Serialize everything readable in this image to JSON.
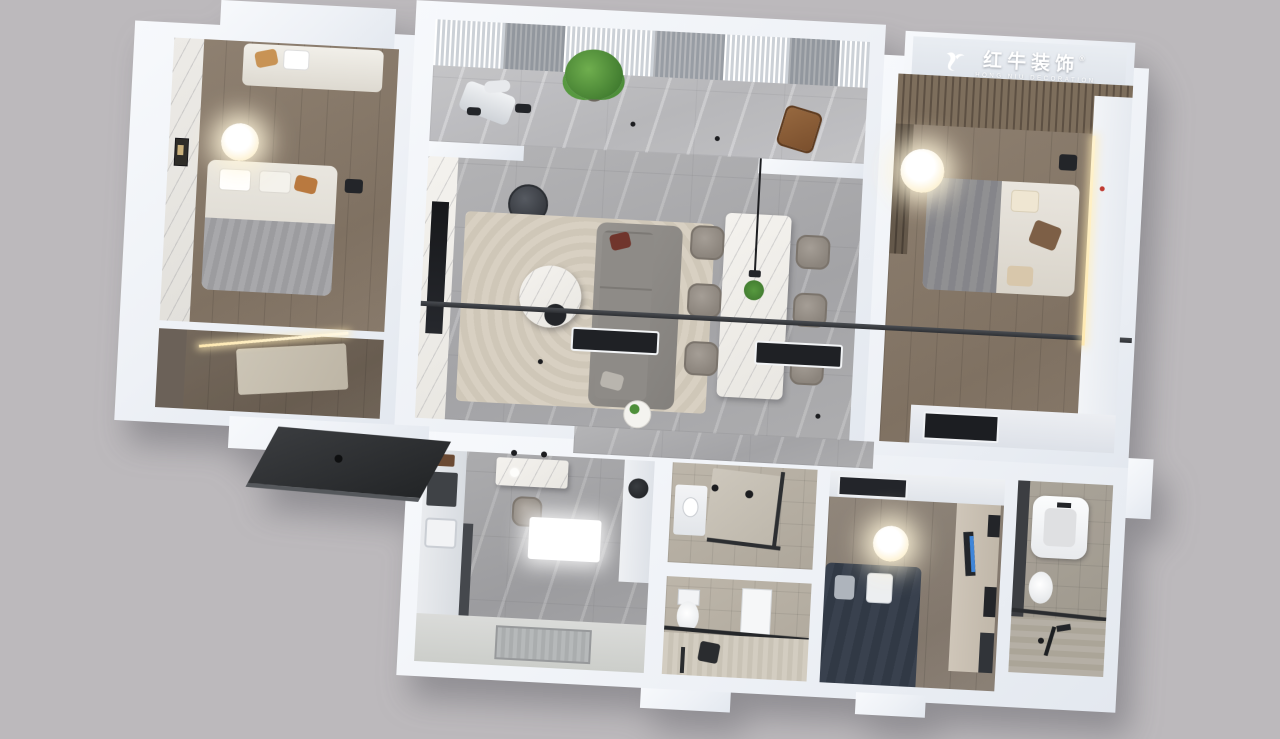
{
  "title": "3D isometric apartment floor-plan render",
  "background_color": "#bcb9bc",
  "logo": {
    "brand": "红牛装饰",
    "registered": "®",
    "subtitle": "HONG NIU DECORATION",
    "icon": "bull-icon",
    "text_color": "#ffffff"
  },
  "palette": {
    "wall": "#eef1f6",
    "marble_floor": "#a9a9ac",
    "wood_floor": "#83755f",
    "rug": "#d5cdbf",
    "sofa": "#8e8b87",
    "accent_dark": "#232529",
    "plant_green": "#4e8f3a",
    "lamp_glow": "#fdf3d8",
    "navy_bed": "#39414e",
    "monitor_blue": "#3f86d9"
  },
  "rooms": [
    {
      "id": "balcony-leisure",
      "floor": "marble",
      "furniture": [
        "vertical-blinds",
        "potted-tree",
        "exercise-machine",
        "lounge-chair"
      ]
    },
    {
      "id": "bedroom-left",
      "floor": "wood",
      "furniture": [
        "double-bed",
        "window-daybed",
        "ceiling-lamp",
        "wall-art",
        "nightstand"
      ]
    },
    {
      "id": "dressing-area",
      "floor": "wood",
      "furniture": [
        "led-strip",
        "rug",
        "closet"
      ]
    },
    {
      "id": "living-room",
      "floor": "marble",
      "furniture": [
        "tv-wall",
        "tv",
        "armchair",
        "area-rug",
        "sofa",
        "coffee-table",
        "side-table",
        "ceiling-beam",
        "ac-vents"
      ]
    },
    {
      "id": "dining-area",
      "floor": "marble",
      "furniture": [
        "marble-dining-table",
        "six-chairs",
        "pendant-light",
        "centerpiece-plant"
      ]
    },
    {
      "id": "master-bedroom",
      "floor": "wood",
      "furniture": [
        "wardrobe-slats",
        "double-bed",
        "glow-ceiling-lamp",
        "tv-cabinet",
        "led-strip"
      ]
    },
    {
      "id": "kitchen",
      "floor": "marble",
      "furniture": [
        "cabinet-run",
        "appliances",
        "ceiling-light-panel",
        "sink",
        "breakfast-bar",
        "bar-chair",
        "pendant-dots"
      ]
    },
    {
      "id": "bathroom-shower",
      "floor": "tile",
      "furniture": [
        "shower-pan",
        "glass-frame",
        "vanity"
      ]
    },
    {
      "id": "bathroom-guest",
      "floor": "tile",
      "furniture": [
        "toilet",
        "bath-mat",
        "glass-partition",
        "shower-set"
      ]
    },
    {
      "id": "bedroom-second",
      "floor": "wood",
      "furniture": [
        "navy-bed",
        "ceiling-lamp",
        "desk",
        "monitor",
        "shelves",
        "ac-unit"
      ]
    },
    {
      "id": "master-bathroom",
      "floor": "tile",
      "furniture": [
        "vanity-basin",
        "toilet",
        "glass-partition",
        "shower-set"
      ]
    },
    {
      "id": "entrance",
      "furniture": [
        "shoe-console"
      ]
    }
  ]
}
